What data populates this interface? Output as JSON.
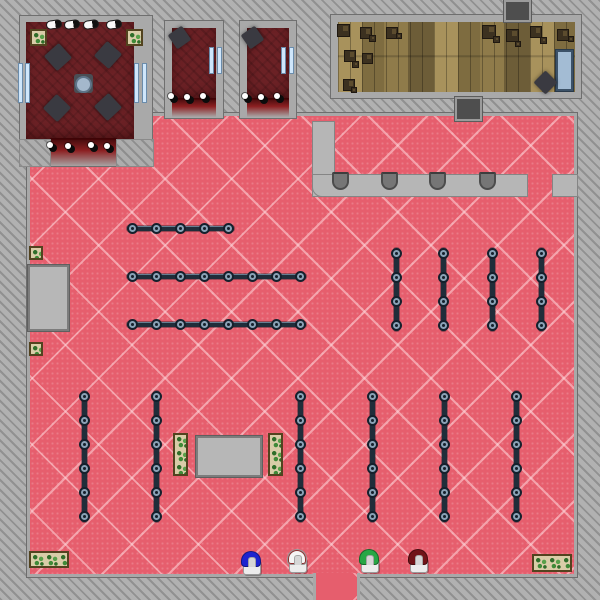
{
  "scene": {
    "kind": "top-down-game-map",
    "description": "Clothing store interior: pink diamond-carpet sales floor, dark-red lounge and two fitting rooms (top-left), wooden stockroom with crates (top-right), checkout counter with stools, clothing racks, display tables, planters, and four colored mannequins by the bottom entrance",
    "canvas": {
      "width": 600,
      "height": 600
    }
  },
  "palette": {
    "background_gray": "#b1b1b1",
    "wall_gray": "#a9a9a9",
    "carpet_pink": "#e65e6d",
    "carpet_lattice": "#f6bcc2",
    "room_dark_red": "#6b2125",
    "door_glow_red": "#880d0f",
    "wood_tan": "#98824d",
    "rack_steel": "#202d3a",
    "rack_ring": "#8aa2b6",
    "counter_gray": "#b6b6b6",
    "window_blue": "#cfe6fb",
    "table_blue": "#a3bcd4",
    "mannequin_blue": "#1d24cf",
    "mannequin_white": "#f5f5f5",
    "mannequin_green": "#27a745",
    "mannequin_red": "#701418"
  },
  "map": {
    "shapes": [
      {
        "name": "sales-floor",
        "cls": "floor",
        "x": 27,
        "y": 113,
        "w": 550,
        "h": 464,
        "inter": false
      },
      {
        "name": "entrance-floor",
        "cls": "floor-ext",
        "x": 313,
        "y": 573,
        "w": 47,
        "h": 27,
        "inter": true
      },
      {
        "name": "lounge-walls",
        "cls": "wall",
        "x": 20,
        "y": 16,
        "w": 132,
        "h": 150,
        "inter": false
      },
      {
        "name": "lounge-floor",
        "cls": "darkroom",
        "x": 26,
        "y": 22,
        "w": 108,
        "h": 118,
        "inter": false
      },
      {
        "name": "lounge-doorway-glow",
        "cls": "doorglow",
        "x": 50,
        "y": 138,
        "w": 67,
        "h": 30,
        "inter": true
      },
      {
        "name": "lounge-corner-block",
        "cls": "hatchblock",
        "x": 20,
        "y": 140,
        "w": 30,
        "h": 26,
        "inter": false
      },
      {
        "name": "lounge-corner-block",
        "cls": "hatchblock",
        "x": 117,
        "y": 140,
        "w": 36,
        "h": 26,
        "inter": false
      },
      {
        "name": "fitting-room-1-walls",
        "cls": "wall",
        "x": 165,
        "y": 21,
        "w": 58,
        "h": 97,
        "inter": false
      },
      {
        "name": "fitting-room-1-floor",
        "cls": "darkroom",
        "x": 172,
        "y": 28,
        "w": 44,
        "h": 72,
        "inter": false
      },
      {
        "name": "fitting-room-1-doorway-glow",
        "cls": "doorglow",
        "x": 172,
        "y": 98,
        "w": 44,
        "h": 20,
        "inter": true
      },
      {
        "name": "fitting-room-2-walls",
        "cls": "wall",
        "x": 240,
        "y": 21,
        "w": 56,
        "h": 97,
        "inter": false
      },
      {
        "name": "fitting-room-2-floor",
        "cls": "darkroom",
        "x": 247,
        "y": 28,
        "w": 42,
        "h": 72,
        "inter": false
      },
      {
        "name": "fitting-room-2-doorway-glow",
        "cls": "doorglow",
        "x": 247,
        "y": 98,
        "w": 42,
        "h": 20,
        "inter": true
      },
      {
        "name": "stockroom-walls",
        "cls": "wall",
        "x": 331,
        "y": 15,
        "w": 250,
        "h": 83,
        "inter": false
      },
      {
        "name": "stockroom-floor",
        "cls": "wood",
        "x": 338,
        "y": 22,
        "w": 237,
        "h": 70,
        "inter": false
      },
      {
        "name": "vent-duct",
        "cls": "duct",
        "x": 504,
        "y": 0,
        "w": 27,
        "h": 22,
        "inter": false
      },
      {
        "name": "vent-duct",
        "cls": "duct",
        "x": 455,
        "y": 97,
        "w": 27,
        "h": 24,
        "inter": false
      },
      {
        "name": "checkout-counter-vertical",
        "cls": "counter",
        "x": 313,
        "y": 122,
        "w": 21,
        "h": 74,
        "inter": true
      },
      {
        "name": "checkout-counter-horizontal",
        "cls": "counter round-bl",
        "x": 313,
        "y": 175,
        "w": 214,
        "h": 21,
        "inter": true
      },
      {
        "name": "checkout-counter-end",
        "cls": "counter",
        "x": 553,
        "y": 175,
        "w": 24,
        "h": 21,
        "inter": true
      },
      {
        "name": "counter-stool",
        "cls": "stool",
        "x": 332,
        "y": 172,
        "w": 17,
        "h": 18,
        "inter": true
      },
      {
        "name": "counter-stool",
        "cls": "stool",
        "x": 381,
        "y": 172,
        "w": 17,
        "h": 18,
        "inter": true
      },
      {
        "name": "counter-stool",
        "cls": "stool",
        "x": 429,
        "y": 172,
        "w": 17,
        "h": 18,
        "inter": true
      },
      {
        "name": "counter-stool",
        "cls": "stool",
        "x": 479,
        "y": 172,
        "w": 17,
        "h": 18,
        "inter": true
      },
      {
        "name": "service-counter",
        "cls": "graytable",
        "x": 28,
        "y": 265,
        "w": 41,
        "h": 66,
        "inter": true
      },
      {
        "name": "display-table",
        "cls": "graytable",
        "x": 196,
        "y": 436,
        "w": 66,
        "h": 41,
        "inter": true
      },
      {
        "name": "display-table-blue",
        "cls": "bluetable",
        "x": 556,
        "y": 50,
        "w": 17,
        "h": 41,
        "inter": true
      },
      {
        "name": "lounge-table",
        "cls": "diamond",
        "x": 48,
        "y": 47,
        "w": 20,
        "h": 20,
        "rot": 48,
        "inter": true
      },
      {
        "name": "lounge-table",
        "cls": "diamond",
        "x": 98,
        "y": 45,
        "w": 20,
        "h": 20,
        "rot": 42,
        "inter": true
      },
      {
        "name": "lounge-table",
        "cls": "diamond",
        "x": 47,
        "y": 98,
        "w": 20,
        "h": 20,
        "rot": 44,
        "inter": true
      },
      {
        "name": "lounge-table",
        "cls": "diamond",
        "x": 98,
        "y": 97,
        "w": 20,
        "h": 20,
        "rot": 47,
        "inter": true
      },
      {
        "name": "fitting-room-bench",
        "cls": "diamond",
        "x": 171,
        "y": 29,
        "w": 17,
        "h": 17,
        "rot": 55,
        "inter": true
      },
      {
        "name": "fitting-room-bench",
        "cls": "diamond",
        "x": 244,
        "y": 29,
        "w": 17,
        "h": 17,
        "rot": 55,
        "inter": true
      },
      {
        "name": "stockroom-bench",
        "cls": "diamond",
        "x": 537,
        "y": 74,
        "w": 17,
        "h": 17,
        "rot": 45,
        "inter": true
      },
      {
        "name": "lounge-pedestal",
        "cls": "pedestal",
        "x": 74,
        "y": 74,
        "w": 19,
        "h": 19,
        "inter": false
      },
      {
        "name": "lounge-round-seat",
        "cls": "orb",
        "x": 75,
        "y": 76,
        "w": 17,
        "h": 17,
        "inter": true
      },
      {
        "name": "planter-tile",
        "cls": "plant",
        "x": 30,
        "y": 29,
        "w": 17,
        "h": 17,
        "inter": false
      },
      {
        "name": "planter-tile",
        "cls": "plant",
        "x": 126,
        "y": 29,
        "w": 17,
        "h": 17,
        "inter": false
      },
      {
        "name": "planter-tile",
        "cls": "plant",
        "x": 29,
        "y": 246,
        "w": 14,
        "h": 14,
        "inter": false
      },
      {
        "name": "planter-tile",
        "cls": "plant",
        "x": 29,
        "y": 342,
        "w": 14,
        "h": 14,
        "inter": false
      },
      {
        "name": "planter-box",
        "cls": "plant",
        "x": 173,
        "y": 433,
        "w": 15,
        "h": 43,
        "inter": false
      },
      {
        "name": "planter-box",
        "cls": "plant",
        "x": 268,
        "y": 433,
        "w": 15,
        "h": 43,
        "inter": false
      },
      {
        "name": "planter-box",
        "cls": "plant",
        "x": 29,
        "y": 551,
        "w": 40,
        "h": 17,
        "inter": false
      },
      {
        "name": "planter-box",
        "cls": "plant",
        "x": 532,
        "y": 554,
        "w": 40,
        "h": 18,
        "inter": false
      },
      {
        "name": "window",
        "cls": "window",
        "x": 18,
        "y": 64,
        "w": 12,
        "h": 38,
        "inter": false
      },
      {
        "name": "window",
        "cls": "window",
        "x": 134,
        "y": 64,
        "w": 13,
        "h": 38,
        "inter": false
      },
      {
        "name": "window",
        "cls": "window",
        "x": 209,
        "y": 48,
        "w": 13,
        "h": 25,
        "inter": false
      },
      {
        "name": "window",
        "cls": "window",
        "x": 281,
        "y": 48,
        "w": 13,
        "h": 25,
        "inter": false
      },
      {
        "name": "wall-light",
        "cls": "pill",
        "x": 46,
        "y": 20,
        "w": 16,
        "h": 9,
        "rot": -8,
        "inter": false
      },
      {
        "name": "wall-light",
        "cls": "pill",
        "x": 64,
        "y": 20,
        "w": 16,
        "h": 9,
        "rot": -8,
        "inter": false
      },
      {
        "name": "wall-light",
        "cls": "pill",
        "x": 83,
        "y": 20,
        "w": 16,
        "h": 9,
        "rot": -8,
        "inter": false
      },
      {
        "name": "wall-light",
        "cls": "pill",
        "x": 106,
        "y": 20,
        "w": 16,
        "h": 9,
        "rot": -8,
        "inter": false
      },
      {
        "name": "spotlight",
        "cls": "dot",
        "x": 47,
        "y": 142,
        "w": 10,
        "h": 10,
        "inter": false
      },
      {
        "name": "spotlight",
        "cls": "dot",
        "x": 65,
        "y": 143,
        "w": 10,
        "h": 10,
        "inter": false
      },
      {
        "name": "spotlight",
        "cls": "dot",
        "x": 88,
        "y": 142,
        "w": 10,
        "h": 10,
        "inter": false
      },
      {
        "name": "spotlight",
        "cls": "dot",
        "x": 104,
        "y": 143,
        "w": 10,
        "h": 10,
        "inter": false
      },
      {
        "name": "spotlight",
        "cls": "dot",
        "x": 168,
        "y": 93,
        "w": 10,
        "h": 10,
        "inter": false
      },
      {
        "name": "spotlight",
        "cls": "dot",
        "x": 184,
        "y": 94,
        "w": 10,
        "h": 10,
        "inter": false
      },
      {
        "name": "spotlight",
        "cls": "dot",
        "x": 200,
        "y": 93,
        "w": 10,
        "h": 10,
        "inter": false
      },
      {
        "name": "spotlight",
        "cls": "dot",
        "x": 242,
        "y": 93,
        "w": 10,
        "h": 10,
        "inter": false
      },
      {
        "name": "spotlight",
        "cls": "dot",
        "x": 258,
        "y": 94,
        "w": 10,
        "h": 10,
        "inter": false
      },
      {
        "name": "spotlight",
        "cls": "dot",
        "x": 274,
        "y": 93,
        "w": 10,
        "h": 10,
        "inter": false
      },
      {
        "name": "crate",
        "cls": "crate",
        "x": 337,
        "y": 24,
        "w": 13,
        "h": 13,
        "inter": true
      },
      {
        "name": "crate",
        "cls": "crate",
        "x": 360,
        "y": 27,
        "w": 12,
        "h": 12,
        "inter": true
      },
      {
        "name": "crate",
        "cls": "crate",
        "x": 369,
        "y": 35,
        "w": 7,
        "h": 7,
        "inter": true
      },
      {
        "name": "crate",
        "cls": "crate",
        "x": 386,
        "y": 27,
        "w": 12,
        "h": 12,
        "inter": true
      },
      {
        "name": "crate",
        "cls": "crate",
        "x": 396,
        "y": 33,
        "w": 6,
        "h": 6,
        "inter": true
      },
      {
        "name": "crate",
        "cls": "crate",
        "x": 482,
        "y": 25,
        "w": 14,
        "h": 14,
        "inter": true
      },
      {
        "name": "crate",
        "cls": "crate",
        "x": 493,
        "y": 36,
        "w": 7,
        "h": 7,
        "inter": true
      },
      {
        "name": "crate",
        "cls": "crate",
        "x": 506,
        "y": 29,
        "w": 13,
        "h": 13,
        "inter": true
      },
      {
        "name": "crate",
        "cls": "crate",
        "x": 515,
        "y": 41,
        "w": 6,
        "h": 6,
        "inter": true
      },
      {
        "name": "crate",
        "cls": "crate",
        "x": 530,
        "y": 26,
        "w": 12,
        "h": 12,
        "inter": true
      },
      {
        "name": "crate",
        "cls": "crate",
        "x": 540,
        "y": 37,
        "w": 7,
        "h": 7,
        "inter": true
      },
      {
        "name": "crate",
        "cls": "crate",
        "x": 557,
        "y": 29,
        "w": 12,
        "h": 12,
        "inter": true
      },
      {
        "name": "crate",
        "cls": "crate",
        "x": 568,
        "y": 36,
        "w": 6,
        "h": 6,
        "inter": true
      },
      {
        "name": "crate",
        "cls": "crate",
        "x": 344,
        "y": 50,
        "w": 12,
        "h": 12,
        "inter": true
      },
      {
        "name": "crate",
        "cls": "crate",
        "x": 352,
        "y": 61,
        "w": 7,
        "h": 7,
        "inter": true
      },
      {
        "name": "crate",
        "cls": "crate",
        "x": 362,
        "y": 53,
        "w": 11,
        "h": 11,
        "inter": true
      },
      {
        "name": "crate",
        "cls": "crate",
        "x": 343,
        "y": 79,
        "w": 12,
        "h": 12,
        "inter": true
      },
      {
        "name": "crate",
        "cls": "crate",
        "x": 351,
        "y": 87,
        "w": 6,
        "h": 6,
        "inter": true
      },
      {
        "name": "mannequin-blue",
        "cls": "mannequin",
        "x": 240,
        "y": 551,
        "w": 22,
        "h": 24,
        "color": "#1d24cf",
        "inter": true
      },
      {
        "name": "mannequin-white",
        "cls": "mannequin",
        "x": 286,
        "y": 549,
        "w": 22,
        "h": 24,
        "color": "#f5f5f5",
        "trim": "#8d2f2f",
        "inter": true
      },
      {
        "name": "mannequin-green",
        "cls": "mannequin",
        "x": 358,
        "y": 549,
        "w": 22,
        "h": 24,
        "color": "#27a745",
        "inter": true
      },
      {
        "name": "mannequin-red",
        "cls": "mannequin",
        "x": 407,
        "y": 549,
        "w": 22,
        "h": 24,
        "color": "#701418",
        "inter": true
      }
    ],
    "racks": [
      {
        "name": "clothing-rack-horizontal",
        "dir": "h",
        "x": 127,
        "y": 228,
        "nodes": 5
      },
      {
        "name": "clothing-rack-horizontal",
        "dir": "h",
        "x": 127,
        "y": 276,
        "nodes": 8
      },
      {
        "name": "clothing-rack-horizontal",
        "dir": "h",
        "x": 127,
        "y": 324,
        "nodes": 8
      },
      {
        "name": "clothing-rack-vertical",
        "dir": "v",
        "x": 396,
        "y": 248,
        "nodes": 4
      },
      {
        "name": "clothing-rack-vertical",
        "dir": "v",
        "x": 443,
        "y": 248,
        "nodes": 4
      },
      {
        "name": "clothing-rack-vertical",
        "dir": "v",
        "x": 492,
        "y": 248,
        "nodes": 4
      },
      {
        "name": "clothing-rack-vertical",
        "dir": "v",
        "x": 541,
        "y": 248,
        "nodes": 4
      },
      {
        "name": "clothing-rack-vertical",
        "dir": "v",
        "x": 84,
        "y": 391,
        "nodes": 6
      },
      {
        "name": "clothing-rack-vertical",
        "dir": "v",
        "x": 156,
        "y": 391,
        "nodes": 6
      },
      {
        "name": "clothing-rack-vertical",
        "dir": "v",
        "x": 300,
        "y": 391,
        "nodes": 6
      },
      {
        "name": "clothing-rack-vertical",
        "dir": "v",
        "x": 372,
        "y": 391,
        "nodes": 6
      },
      {
        "name": "clothing-rack-vertical",
        "dir": "v",
        "x": 444,
        "y": 391,
        "nodes": 6
      },
      {
        "name": "clothing-rack-vertical",
        "dir": "v",
        "x": 516,
        "y": 391,
        "nodes": 6
      }
    ],
    "rack_node_spacing": 24
  }
}
